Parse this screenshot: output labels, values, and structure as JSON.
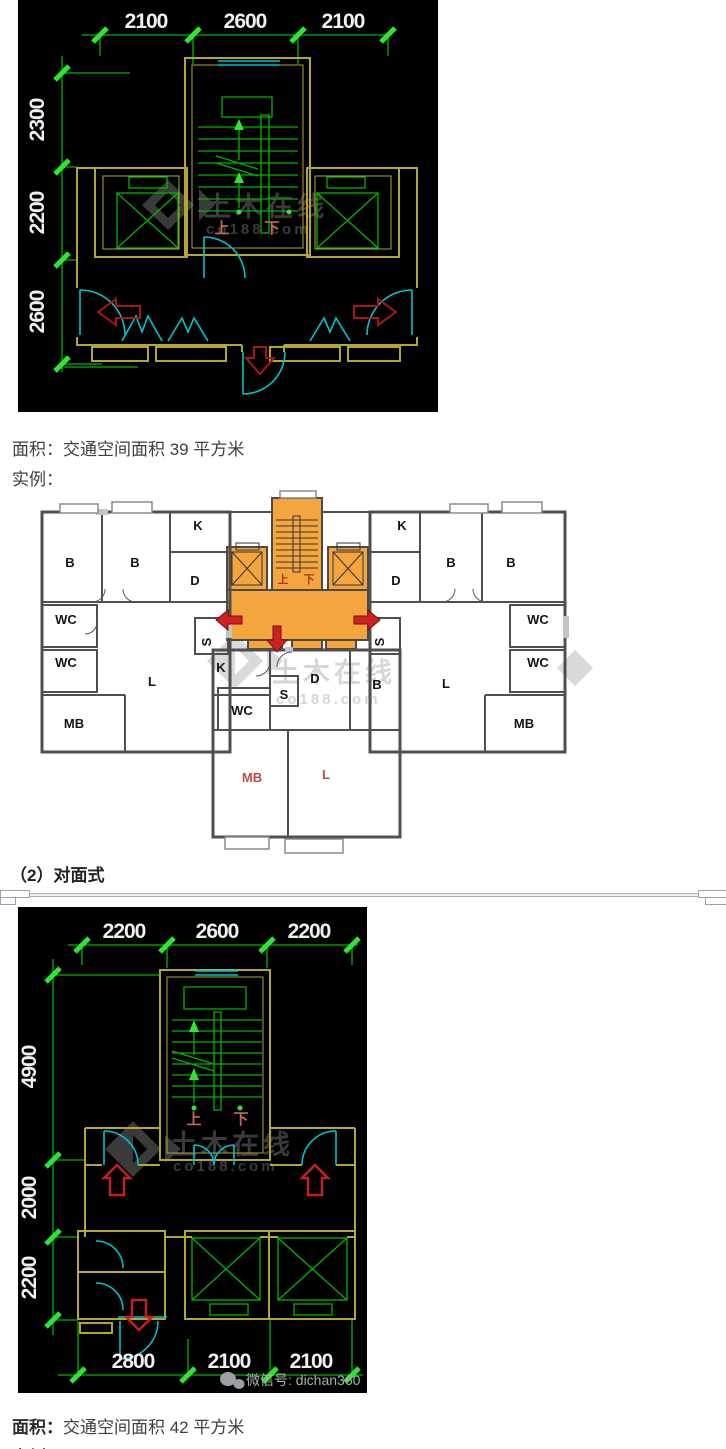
{
  "colors": {
    "green": "#00b400",
    "green_bright": "#2ee62e",
    "yellow": "#b3a632",
    "cyan": "#00c3cf",
    "red_dark": "#a81616",
    "red_bright": "#c42020",
    "orange": "#f4a53d",
    "wall_gray": "#4f4f4f",
    "dim_text": "#f0f0f0",
    "stair_label": "#c2695a",
    "wm_dark": "#3a3a3a",
    "wm_light": "#d6d6d6",
    "plan_red": "#cc2222"
  },
  "captions": {
    "area1_prefix": "面积：",
    "area1_text": "交通空间面积 39 平方米",
    "example1": "实例：",
    "heading2": "（2）对面式",
    "area2_prefix": "面积：",
    "area2_text": "交通空间面积 42 平方米",
    "example2": "实例："
  },
  "cad1": {
    "top_dims": [
      {
        "t": "2100",
        "x": 128,
        "y": 28
      },
      {
        "t": "2600",
        "x": 227,
        "y": 28
      },
      {
        "t": "2100",
        "x": 325,
        "y": 28
      }
    ],
    "left_dims": [
      {
        "t": "2300",
        "x": 26,
        "y": 120,
        "rot": -90
      },
      {
        "t": "2200",
        "x": 26,
        "y": 213,
        "rot": -90
      },
      {
        "t": "2600",
        "x": 26,
        "y": 312,
        "rot": -90
      }
    ],
    "stair_labels": [
      {
        "t": "上",
        "x": 204,
        "y": 233
      },
      {
        "t": "下",
        "x": 254,
        "y": 233
      }
    ],
    "watermark": [
      {
        "t": "土木在线",
        "x": 186,
        "y": 216
      },
      {
        "t": "co188.com",
        "x": 188,
        "y": 234,
        "cls": "en"
      }
    ]
  },
  "floorplan": {
    "room_labels": [
      {
        "t": "B",
        "x": 40,
        "y": 77
      },
      {
        "t": "B",
        "x": 105,
        "y": 77
      },
      {
        "t": "K",
        "x": 168,
        "y": 40
      },
      {
        "t": "D",
        "x": 165,
        "y": 95
      },
      {
        "t": "WC",
        "x": 36,
        "y": 134
      },
      {
        "t": "WC",
        "x": 36,
        "y": 177
      },
      {
        "t": "L",
        "x": 122,
        "y": 196
      },
      {
        "t": "MB",
        "x": 44,
        "y": 238
      },
      {
        "t": "S",
        "x": 181,
        "y": 152,
        "rot": -90
      },
      {
        "t": "K",
        "x": 372,
        "y": 40
      },
      {
        "t": "D",
        "x": 366,
        "y": 95
      },
      {
        "t": "B",
        "x": 421,
        "y": 77
      },
      {
        "t": "B",
        "x": 481,
        "y": 77
      },
      {
        "t": "WC",
        "x": 508,
        "y": 134
      },
      {
        "t": "WC",
        "x": 508,
        "y": 177
      },
      {
        "t": "L",
        "x": 416,
        "y": 198
      },
      {
        "t": "MB",
        "x": 494,
        "y": 238
      },
      {
        "t": "S",
        "x": 354,
        "y": 152,
        "rot": -90
      },
      {
        "t": "K",
        "x": 191,
        "y": 182
      },
      {
        "t": "WC",
        "x": 212,
        "y": 225
      },
      {
        "t": "S",
        "x": 254,
        "y": 209
      },
      {
        "t": "D",
        "x": 285,
        "y": 193
      },
      {
        "t": "B",
        "x": 347,
        "y": 199
      },
      {
        "t": "MB",
        "x": 222,
        "y": 292,
        "cls": "red"
      },
      {
        "t": "L",
        "x": 296,
        "y": 289,
        "cls": "red"
      }
    ],
    "stair_labels": [
      {
        "t": "上",
        "x": 253,
        "y": 93
      },
      {
        "t": "下",
        "x": 279,
        "y": 93
      }
    ],
    "watermark": [
      {
        "t": "土木在线",
        "x": 242,
        "y": 192
      },
      {
        "t": "co188.com",
        "x": 246,
        "y": 214,
        "cls": "en"
      }
    ]
  },
  "cad2": {
    "top_dims": [
      {
        "t": "2200",
        "x": 106,
        "y": 31
      },
      {
        "t": "2600",
        "x": 199,
        "y": 31
      },
      {
        "t": "2200",
        "x": 291,
        "y": 31
      }
    ],
    "left_dims": [
      {
        "t": "4900",
        "x": 18,
        "y": 160,
        "rot": -90
      },
      {
        "t": "2000",
        "x": 18,
        "y": 291,
        "rot": -90
      },
      {
        "t": "2200",
        "x": 18,
        "y": 371,
        "rot": -90
      }
    ],
    "bottom_dims": [
      {
        "t": "2800",
        "x": 115,
        "y": 461
      },
      {
        "t": "2100",
        "x": 211,
        "y": 461
      },
      {
        "t": "2100",
        "x": 293,
        "y": 461
      }
    ],
    "stair_labels": [
      {
        "t": "上",
        "x": 176,
        "y": 217
      },
      {
        "t": "下",
        "x": 223,
        "y": 217
      }
    ],
    "watermark": [
      {
        "t": "土木在线",
        "x": 152,
        "y": 247
      },
      {
        "t": "co188.com",
        "x": 155,
        "y": 264,
        "cls": "en"
      }
    ],
    "wechat": [
      {
        "t": "微信号: dichan360",
        "x": 228,
        "y": 478
      }
    ]
  }
}
